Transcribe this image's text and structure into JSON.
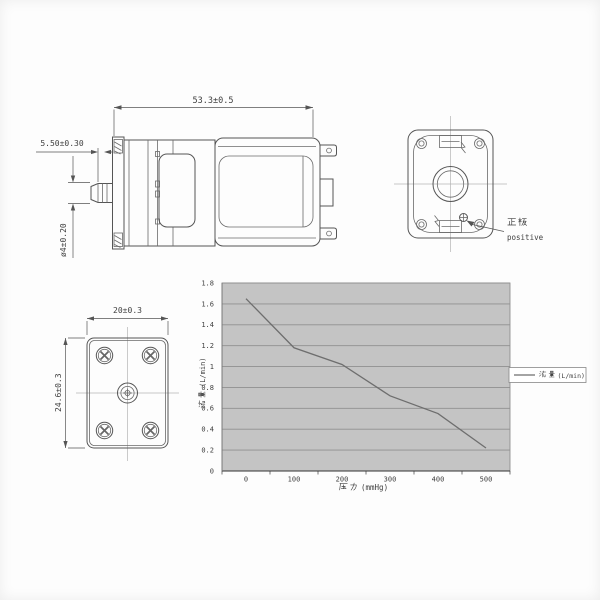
{
  "side_view": {
    "length_dim": "53.3±0.5",
    "inlet_len_dim": "5.50±0.30",
    "inlet_dia_dim": "ø4±0.20"
  },
  "rear_view": {
    "polarity_label_cjk": "正极",
    "polarity_label_en": "positive"
  },
  "bottom_view": {
    "width_dim": "20±0.3",
    "height_dim": "24.6±0.3"
  },
  "chart": {
    "ylabel_cjk": "流量",
    "ylabel_unit": "(L/min)",
    "xlabel_cjk": "压力",
    "xlabel_unit": "(mmHg)",
    "legend_cjk": "流量",
    "legend_unit": "(L/min)"
  },
  "chart_data": {
    "type": "line",
    "x": [
      0,
      100,
      200,
      300,
      400,
      500
    ],
    "series": [
      {
        "name": "流量 (L/min)",
        "values": [
          1.65,
          1.18,
          1.02,
          0.72,
          0.55,
          0.22
        ]
      }
    ],
    "title": "",
    "xlabel": "压力 (mmHg)",
    "ylabel": "流量 (L/min)",
    "ylim": [
      0,
      1.8
    ],
    "ytick_step": 0.2,
    "xlim_extra_right": 50,
    "grid": "horizontal",
    "legend_position": "right",
    "plot_bg": "#c4c4c4",
    "gridline_color": "#8f8f8f",
    "series_color": "#6e6e6e"
  }
}
